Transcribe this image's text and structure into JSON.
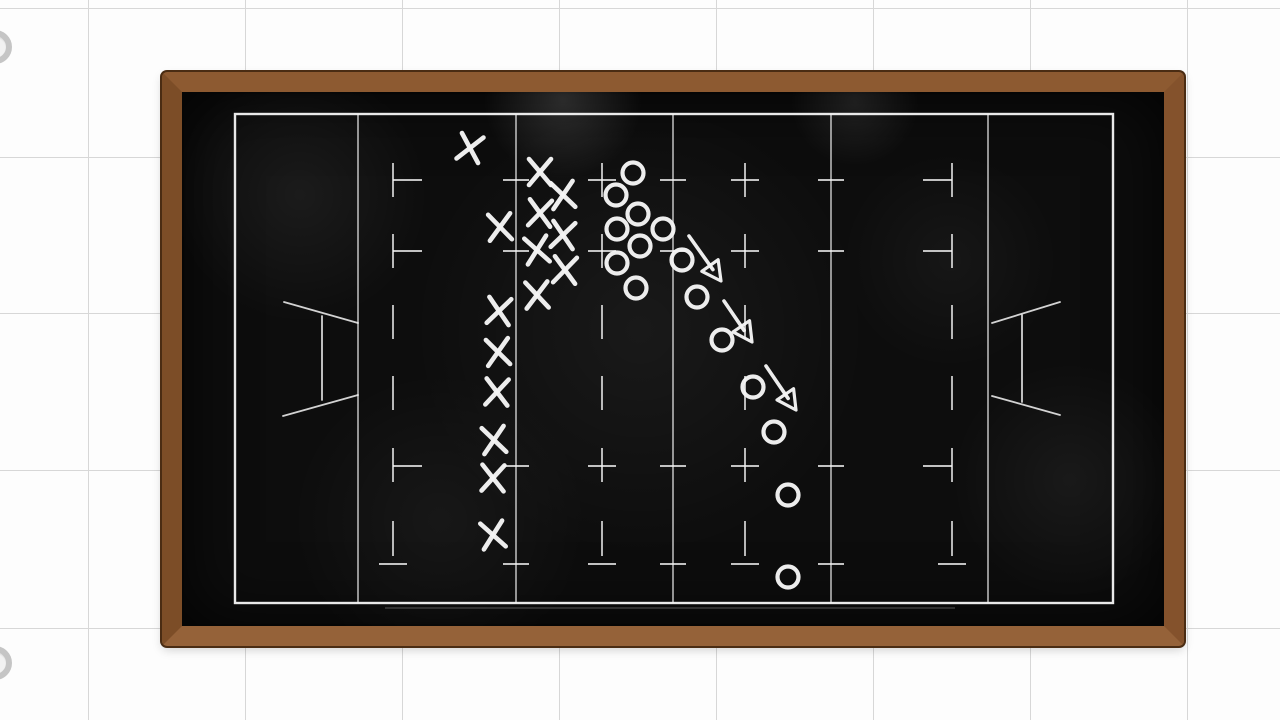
{
  "background": {
    "color": "#fdfdfd",
    "grid": {
      "line_color": "#d7d7d7",
      "vertical_x": [
        88,
        245,
        402,
        559,
        716,
        873,
        1030,
        1187
      ],
      "horizontal_y": [
        8,
        157,
        313,
        470,
        628
      ]
    },
    "rings": [
      {
        "cx": -5,
        "cy": 47,
        "r": 17
      },
      {
        "cx": -5,
        "cy": 663,
        "r": 17
      }
    ],
    "ring_color": "#c5c5c5"
  },
  "chalkboard": {
    "frame": {
      "x": 162,
      "y": 72,
      "width": 1022,
      "height": 574,
      "wood_thickness": 20
    },
    "wood_color": "#8a5730",
    "wood_edge_color": "#4a2c13",
    "surface_color": "#0d0d0d",
    "smudges": [
      [
        563,
        100,
        80,
        0.14
      ],
      [
        855,
        102,
        65,
        0.09
      ],
      [
        300,
        195,
        130,
        0.06
      ],
      [
        640,
        330,
        230,
        0.05
      ],
      [
        440,
        520,
        150,
        0.045
      ],
      [
        1070,
        480,
        120,
        0.05
      ],
      [
        950,
        260,
        110,
        0.04
      ]
    ]
  },
  "field": {
    "chalk_color": "#f5f5f5",
    "rect": {
      "x": 235,
      "y": 114,
      "width": 878,
      "height": 489
    },
    "bottom_echo": [
      385,
      608,
      955,
      608
    ],
    "solid_vlines": [
      358,
      516,
      673,
      831,
      988
    ],
    "ticked_vlines": [
      516,
      673,
      831
    ],
    "dashed_vlines": [
      {
        "x": 393,
        "tick_side": "right"
      },
      {
        "x": 602,
        "tick_side": "center"
      },
      {
        "x": 745,
        "tick_side": "center"
      },
      {
        "x": 952,
        "tick_side": "left"
      }
    ],
    "dash_y_segments": [
      [
        163,
        197
      ],
      [
        234,
        268
      ],
      [
        305,
        339
      ],
      [
        376,
        410
      ],
      [
        448,
        482
      ],
      [
        521,
        556
      ]
    ],
    "tick_rows_y": [
      180,
      251,
      466,
      564
    ],
    "tick_half_width": 13,
    "goal_post_left": [
      [
        284,
        302,
        358,
        323
      ],
      [
        322,
        316,
        322,
        400
      ],
      [
        283,
        416,
        358,
        395
      ]
    ],
    "goal_post_right": [
      [
        1060,
        302,
        992,
        323
      ],
      [
        1022,
        315,
        1022,
        402
      ],
      [
        992,
        396,
        1060,
        415
      ]
    ]
  },
  "play": {
    "x_team": [
      [
        470,
        148,
        12
      ],
      [
        540,
        172,
        0
      ],
      [
        563,
        195,
        -6
      ],
      [
        540,
        213,
        4
      ],
      [
        500,
        227,
        -4
      ],
      [
        563,
        235,
        6
      ],
      [
        537,
        250,
        -8
      ],
      [
        565,
        270,
        4
      ],
      [
        537,
        295,
        -3
      ],
      [
        499,
        311,
        6
      ],
      [
        498,
        352,
        -5
      ],
      [
        497,
        392,
        3
      ],
      [
        494,
        440,
        -6
      ],
      [
        493,
        478,
        2
      ],
      [
        493,
        535,
        -8
      ]
    ],
    "o_team": [
      [
        633,
        173
      ],
      [
        616,
        195
      ],
      [
        638,
        214
      ],
      [
        617,
        229
      ],
      [
        663,
        229
      ],
      [
        640,
        246
      ],
      [
        617,
        263
      ],
      [
        682,
        260
      ],
      [
        636,
        288
      ],
      [
        697,
        297
      ],
      [
        722,
        340
      ],
      [
        753,
        387
      ],
      [
        774,
        432
      ],
      [
        788,
        495
      ],
      [
        788,
        577
      ]
    ],
    "arrows": [
      [
        689,
        236,
        721,
        281
      ],
      [
        724,
        301,
        752,
        342
      ],
      [
        766,
        366,
        796,
        410
      ]
    ],
    "marker_style": {
      "x_half_width": 11,
      "x_half_height": 13,
      "x_stroke": 4.6,
      "o_radius": 10.5,
      "o_stroke": 4.2,
      "arrow_stroke": 3.6,
      "head_length": 19,
      "head_half_width": 10,
      "head_stroke": 3.2
    }
  }
}
